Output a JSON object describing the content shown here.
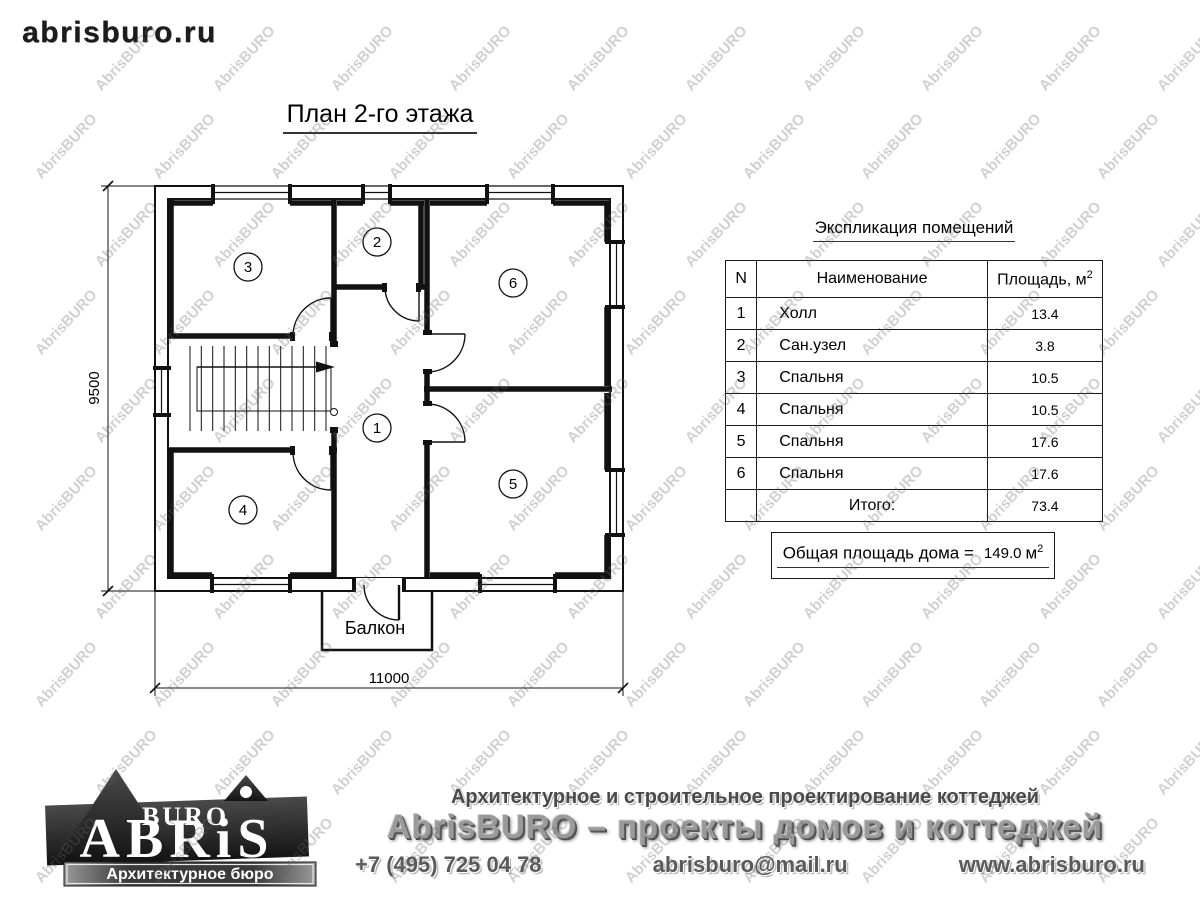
{
  "page": {
    "site_logo": "abrisburo.ru",
    "title": "План 2-го этажа"
  },
  "plan": {
    "room_numbers": [
      "1",
      "2",
      "3",
      "4",
      "5",
      "6"
    ],
    "balcony_label": "Балкон",
    "dim_height": "9500",
    "dim_width": "11000"
  },
  "table": {
    "title": "Экспликация помещений",
    "headers": {
      "n": "N",
      "name": "Наименование",
      "area": "Площадь, м",
      "area_sup": "2"
    },
    "rows": [
      {
        "n": "1",
        "name": "Холл",
        "area": "13.4"
      },
      {
        "n": "2",
        "name": "Сан.узел",
        "area": "3.8"
      },
      {
        "n": "3",
        "name": "Спальня",
        "area": "10.5"
      },
      {
        "n": "4",
        "name": "Спальня",
        "area": "10.5"
      },
      {
        "n": "5",
        "name": "Спальня",
        "area": "17.6"
      },
      {
        "n": "6",
        "name": "Спальня",
        "area": "17.6"
      }
    ],
    "total_label": "Итого:",
    "total_value": "73.4"
  },
  "summary": {
    "label": "Общая площадь дома =",
    "value": "149.0",
    "unit": "м",
    "unit_sup": "2"
  },
  "footer": {
    "logo": {
      "top": "BURO",
      "main": "ABRiS",
      "tagline": "Архитектурное бюро"
    },
    "line1": "Архитектурное и строительное проектирование коттеджей",
    "line2": "AbrisBURO – проекты домов и коттеджей",
    "phone": "+7 (495) 725 04 78",
    "email": "abrisburo@mail.ru",
    "website": "www.abrisburo.ru"
  },
  "watermark": {
    "text": "AbrisBURO"
  }
}
